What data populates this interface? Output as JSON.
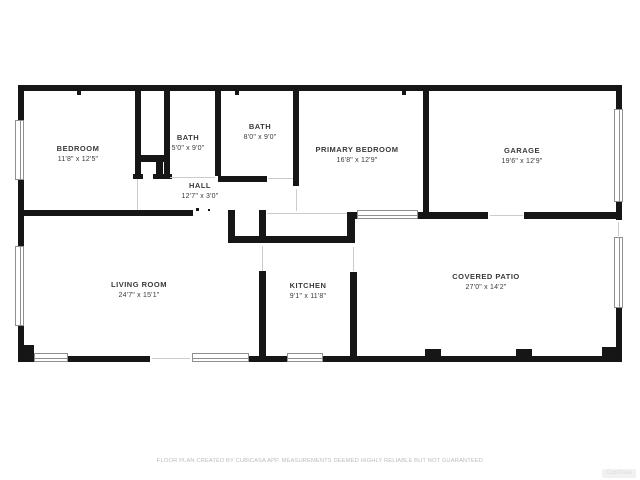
{
  "plan": {
    "wall_color": "#161616",
    "rooms": [
      {
        "name": "BEDROOM",
        "dims": "11'8\" x 12'5\""
      },
      {
        "name": "BATH",
        "dims": "5'0\" x 9'0\""
      },
      {
        "name": "BATH",
        "dims": "8'0\" x 9'0\""
      },
      {
        "name": "HALL",
        "dims": "12'7\" x 3'0\""
      },
      {
        "name": "PRIMARY BEDROOM",
        "dims": "16'8\" x 12'9\""
      },
      {
        "name": "GARAGE",
        "dims": "19'6\" x 12'9\""
      },
      {
        "name": "LIVING ROOM",
        "dims": "24'7\" x 15'1\""
      },
      {
        "name": "KITCHEN",
        "dims": "9'1\" x 11'8\""
      },
      {
        "name": "COVERED PATIO",
        "dims": "27'0\" x 14'2\""
      }
    ],
    "footer": "FLOOR PLAN CREATED BY CUBICASA APP. MEASUREMENTS DEEMED HIGHLY RELIABLE BUT NOT GUARANTEED",
    "watermark": "CubiCasa"
  }
}
